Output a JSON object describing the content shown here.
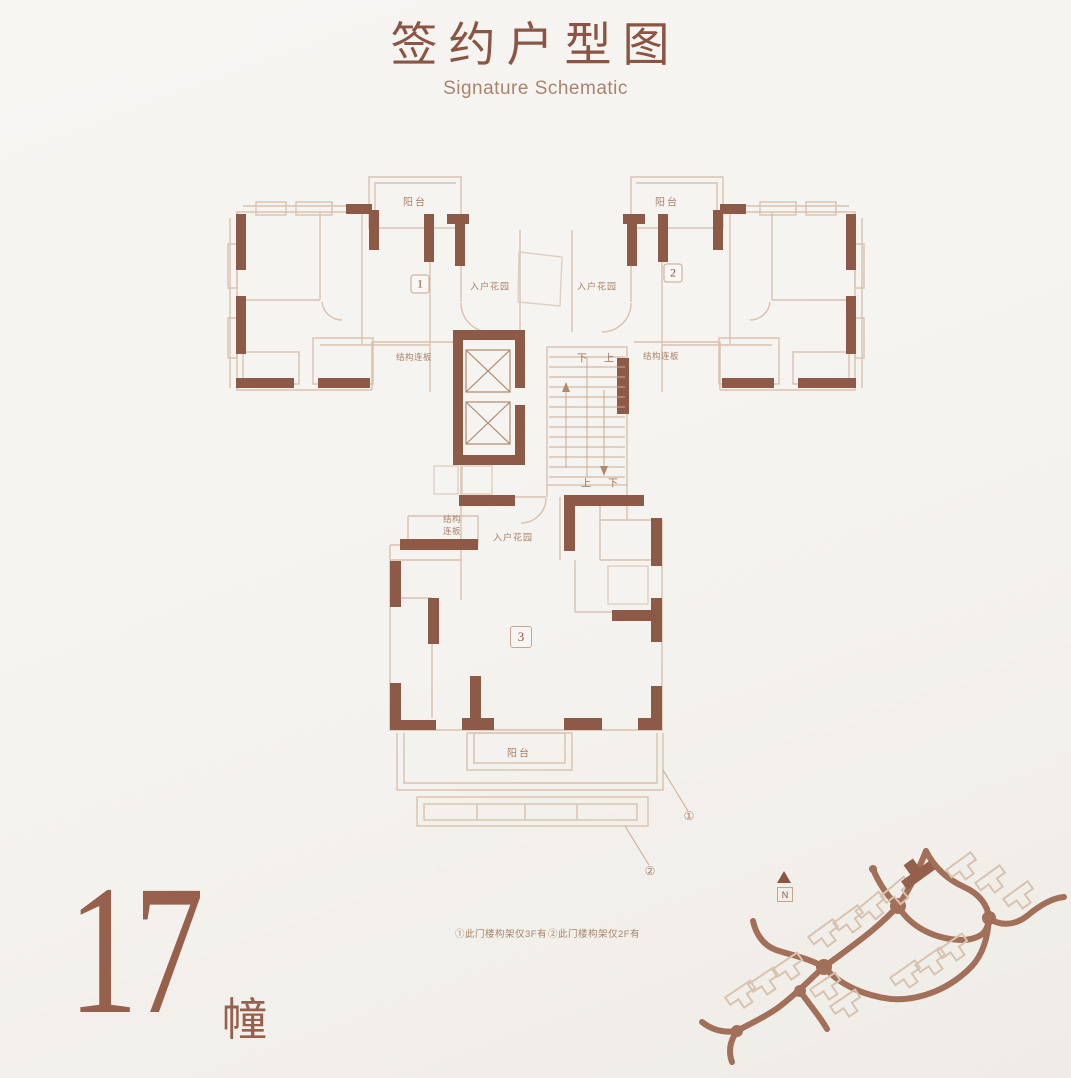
{
  "header": {
    "title": "签约户型图",
    "subtitle": "Signature Schematic"
  },
  "plan": {
    "units": {
      "u1": "1",
      "u2": "2",
      "u3": "3"
    },
    "labels": {
      "balcony": "阳台",
      "entry_garden": "入户花园",
      "structural_slab": "结构连板",
      "structural_slab_l1": "结构",
      "structural_slab_l2": "连板",
      "up": "上",
      "down": "下"
    },
    "callouts": {
      "c1": "①",
      "c2": "②"
    }
  },
  "building": {
    "number": "17",
    "suffix": "幢"
  },
  "footnotes": {
    "f1": "①此门楼构架仅3F有",
    "f2": "②此门楼构架仅2F有"
  },
  "site_map": {
    "north": "N"
  },
  "colors": {
    "accent": "#8a5544",
    "wall_dark": "#8e5a48",
    "wall_light": "#d8c2b0",
    "road": "#a26f58",
    "label_text": "#a8826a"
  }
}
